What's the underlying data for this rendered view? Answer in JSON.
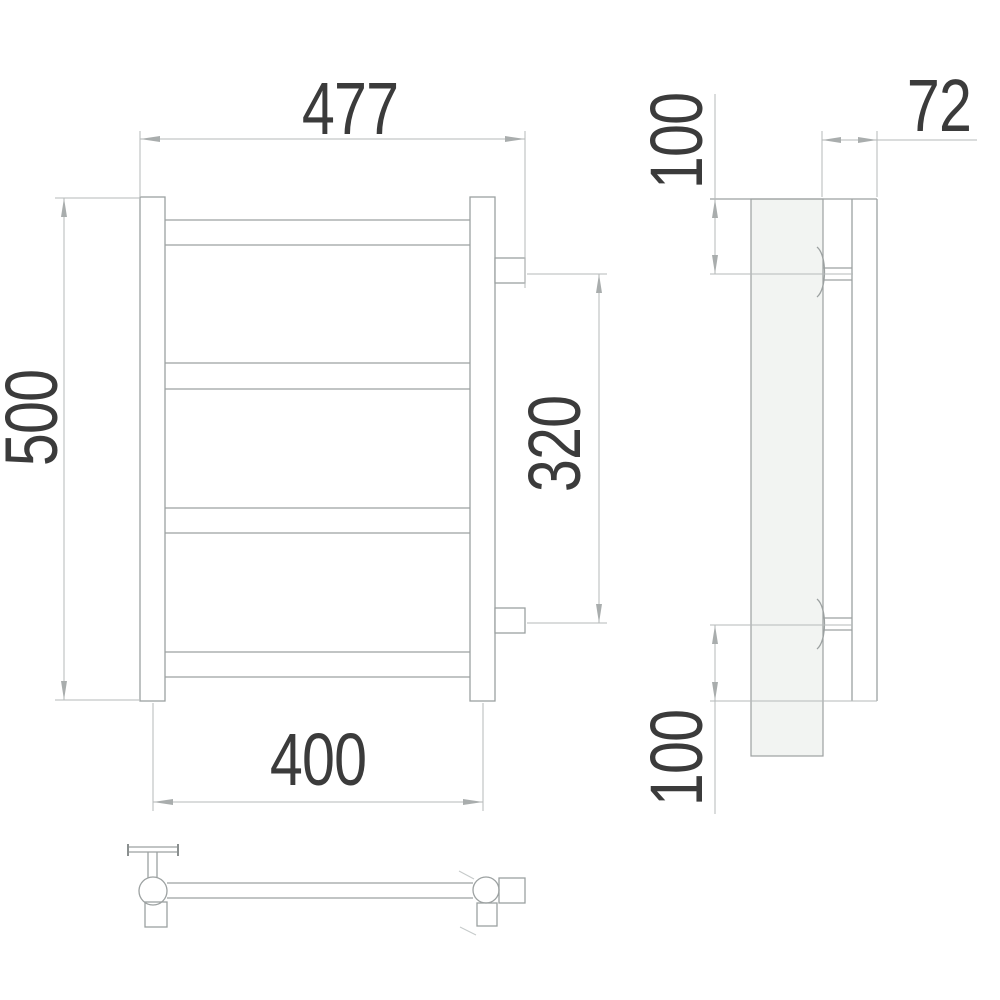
{
  "drawing": {
    "type": "dimensioned technical drawing of wall-mounted ladder towel rail",
    "views": {
      "front": "front elevation with four cross rails",
      "side": "side profile with wall plate",
      "bottom": "bottom rail plan view"
    },
    "dimensions": {
      "overall_width": "477",
      "overall_height": "500",
      "connection_spacing": "320",
      "mounting_centers_width": "400",
      "depth": "72",
      "top_connection_offset": "100",
      "bottom_connection_offset": "100"
    },
    "colors": {
      "line": "#9ca1a1",
      "dimension_line": "#b6baba",
      "text": "#3b3b3b",
      "panel_fill": "#f2f4f2",
      "background": "#ffffff"
    }
  }
}
